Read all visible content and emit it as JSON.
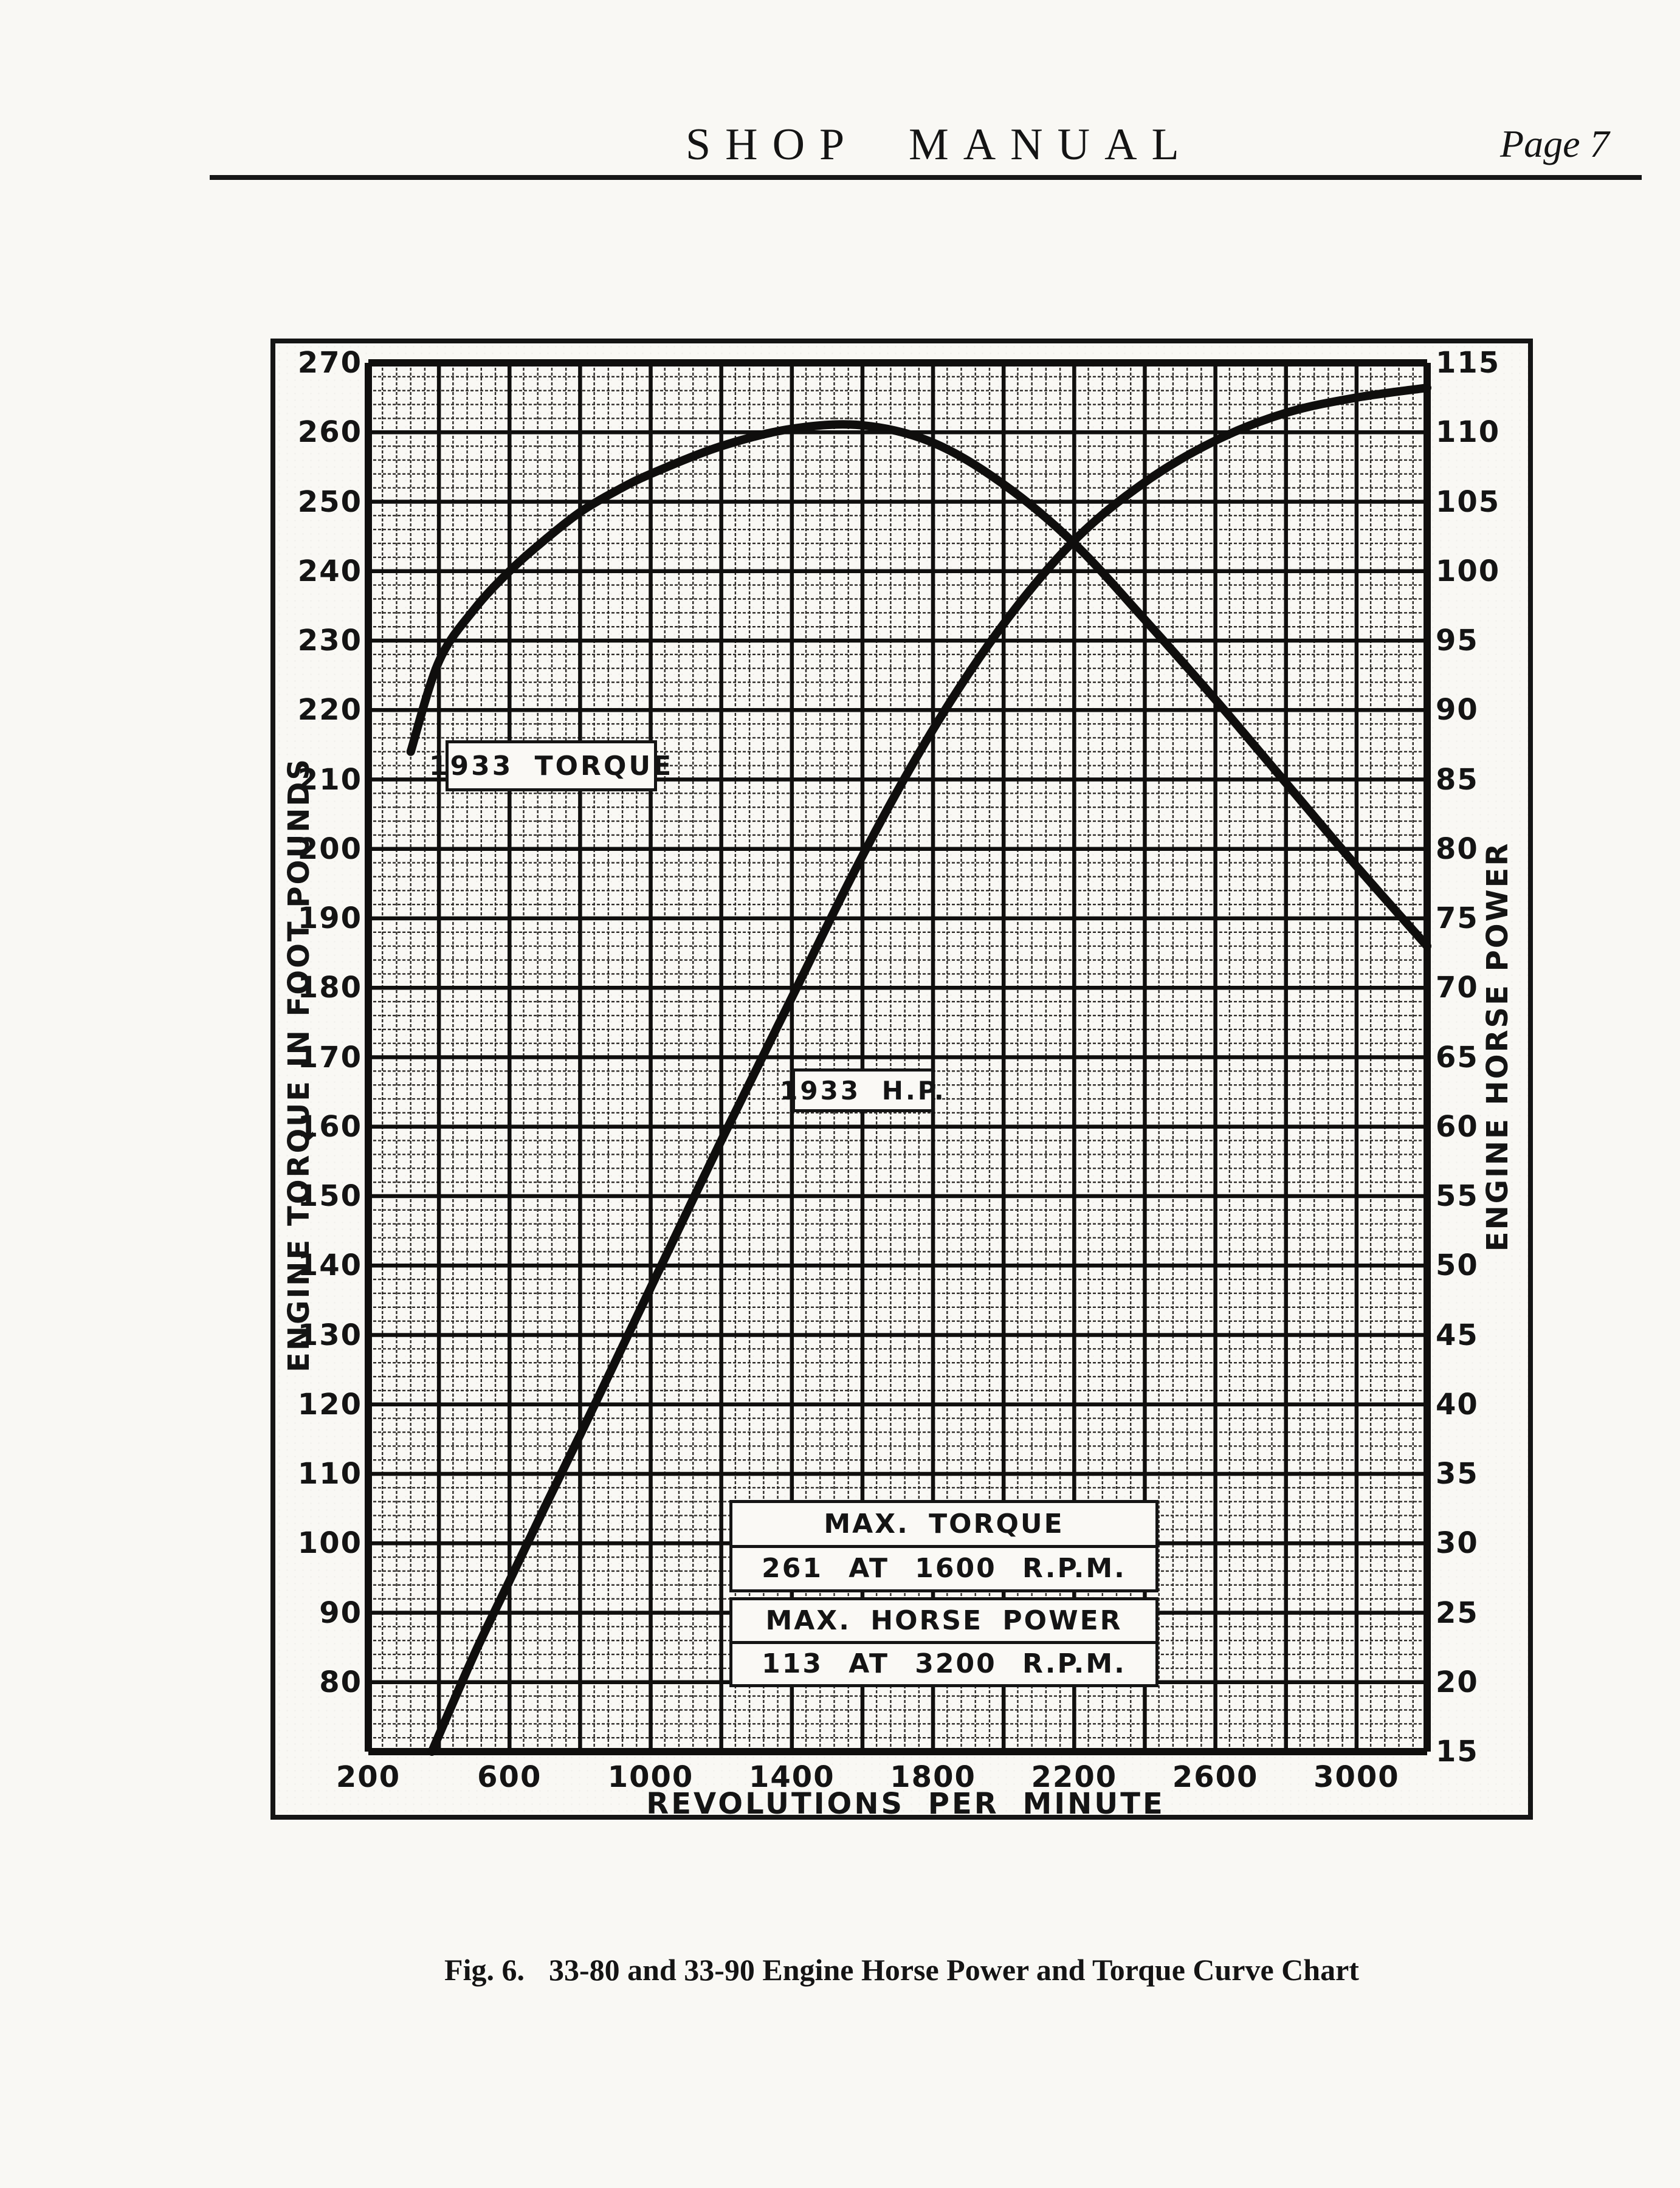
{
  "ink": "#141414",
  "paper": "#f9f8f4",
  "header": {
    "title": "SHOP MANUAL",
    "page_label": "Page 7"
  },
  "figure": {
    "caption_prefix": "Fig. 6.",
    "caption_text": "33-80 and 33-90 Engine Horse Power and Torque Curve Chart"
  },
  "chart_data": {
    "type": "line",
    "title": "",
    "xlabel": "REVOLUTIONS PER MINUTE",
    "ylabel_left": "ENGINE TORQUE IN FOOT POUNDS",
    "ylabel_right": "ENGINE HORSE POWER",
    "x_range": [
      200,
      3200
    ],
    "x_tick_labels": [
      200,
      600,
      1000,
      1400,
      1800,
      2200,
      2600,
      3000
    ],
    "left_range": [
      70,
      270
    ],
    "left_tick_labels": [
      270,
      260,
      250,
      240,
      230,
      220,
      210,
      200,
      190,
      180,
      170,
      160,
      150,
      140,
      130,
      120,
      110,
      100,
      90,
      80
    ],
    "right_range": [
      15,
      115
    ],
    "right_tick_labels": [
      115,
      110,
      105,
      100,
      95,
      90,
      85,
      80,
      75,
      70,
      65,
      60,
      55,
      50,
      45,
      40,
      35,
      30,
      25,
      20,
      15
    ],
    "grid": {
      "on": true,
      "major_rpm_step": 200,
      "minor_rpm_step": 40,
      "major_left_step": 10,
      "minor_left_step": 2,
      "major_right_step": 5,
      "minor_right_step": 1
    },
    "series": [
      {
        "name": "1933 TORQUE",
        "axis": "left",
        "units": "foot pounds",
        "points": [
          [
            320,
            214
          ],
          [
            400,
            227
          ],
          [
            500,
            234.5
          ],
          [
            600,
            240
          ],
          [
            700,
            244.5
          ],
          [
            800,
            248.5
          ],
          [
            900,
            251.5
          ],
          [
            1000,
            254
          ],
          [
            1200,
            258
          ],
          [
            1400,
            260.5
          ],
          [
            1600,
            261
          ],
          [
            1800,
            258.5
          ],
          [
            2000,
            252.5
          ],
          [
            2200,
            244
          ],
          [
            2400,
            233
          ],
          [
            2600,
            221.5
          ],
          [
            2800,
            209.5
          ],
          [
            3000,
            197.5
          ],
          [
            3200,
            186
          ]
        ]
      },
      {
        "name": "1933 H.P.",
        "axis": "right",
        "units": "horse power",
        "points": [
          [
            380,
            15
          ],
          [
            500,
            22
          ],
          [
            600,
            27.3
          ],
          [
            700,
            32.6
          ],
          [
            800,
            37.8
          ],
          [
            900,
            43.1
          ],
          [
            1000,
            48.4
          ],
          [
            1200,
            59
          ],
          [
            1400,
            69.3
          ],
          [
            1600,
            79.5
          ],
          [
            1800,
            88.6
          ],
          [
            2000,
            96.2
          ],
          [
            2200,
            102.2
          ],
          [
            2400,
            106.4
          ],
          [
            2600,
            109.4
          ],
          [
            2800,
            111.4
          ],
          [
            3000,
            112.5
          ],
          [
            3200,
            113.2
          ]
        ]
      }
    ],
    "annotations": [
      {
        "label": "1933 TORQUE"
      },
      {
        "label": "1933 H.P."
      },
      {
        "title": "MAX. TORQUE",
        "value": "261 AT 1600 R.P.M."
      },
      {
        "title": "MAX. HORSE POWER",
        "value": "113 AT 3200 R.P.M."
      }
    ],
    "max_torque": {
      "value": 261,
      "rpm": 1600
    },
    "max_horse_power": {
      "value": 113,
      "rpm": 3200
    }
  }
}
